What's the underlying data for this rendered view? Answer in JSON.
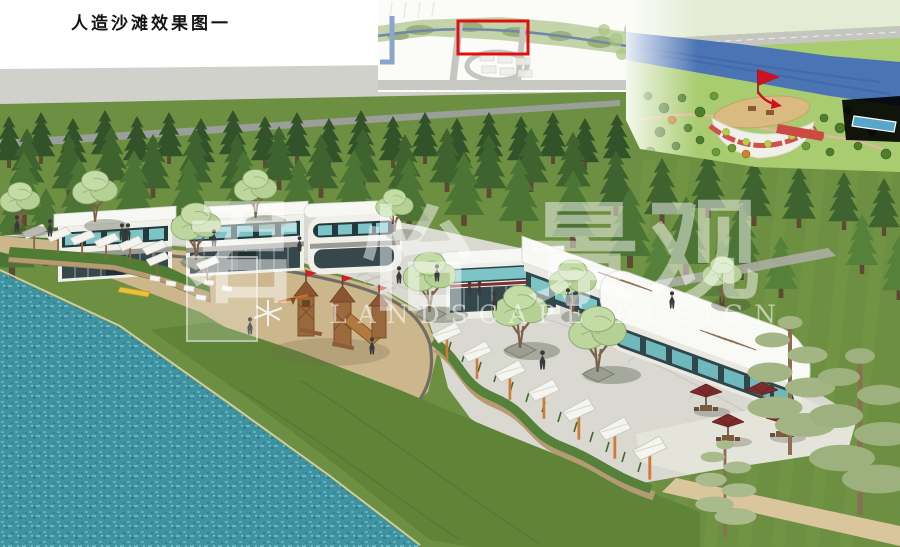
{
  "page": {
    "title": "人造沙滩效果图一"
  },
  "watermark": {
    "chars": [
      "君",
      "怡",
      "景",
      "观"
    ],
    "latin": "LANDSCAPE DESIGN"
  },
  "insets": {
    "key_map": {
      "highlight_color": "#e01010"
    },
    "master_plan": {
      "marker_color": "#cc1122"
    }
  },
  "palette": {
    "water": "#3e92a2",
    "sand": "#cbb78b",
    "meadow": "#6d8f41",
    "forest": "#3f632e",
    "paving": "#d9d9d2",
    "building_white": "#f6f6f2",
    "glass_teal": "#7cc4c6",
    "storefront_dark": "#33484c",
    "umbrella_red": "#7c2b2b",
    "sail_post_orange": "#d07a35",
    "playground_wood": "#99683c",
    "river_blue": "#4a74b4"
  }
}
